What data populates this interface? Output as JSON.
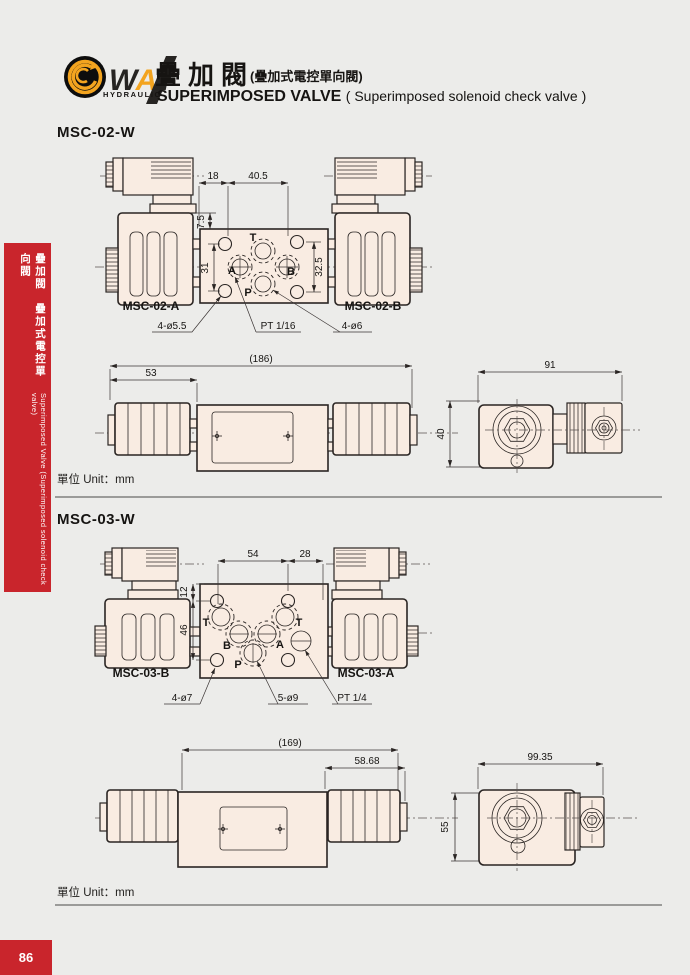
{
  "page": {
    "number": "86",
    "bg_color": "#ececea",
    "accent_red": "#c9252c",
    "drawing_fill": "#f9ece2",
    "logo_orange": "#f3a41f"
  },
  "header": {
    "logo": {
      "w": "W",
      "a": "A",
      "y": "Y",
      "hydraulic": "HYDRAULIC"
    },
    "title_zh": "疊加閥",
    "title_zh_paren": "(疊加式電控單向閥)",
    "title_en": "SUPERIMPOSED VALVE ",
    "title_en_paren": "( Superimposed solenoid check valve )"
  },
  "sidebar": {
    "zh": "疊加閥　疊加式電控單向閥",
    "en": "Superimposed Valve (Superimposed solenoid check valve)"
  },
  "msc02": {
    "title": "MSC-02-W",
    "unit": "單位 Unit：mm",
    "top": {
      "dim_a": "18",
      "dim_b": "40.5",
      "dim_c": "7.5",
      "dim_d": "31",
      "dim_e": "32.5",
      "port_t": "T",
      "port_a": "A",
      "port_b": "B",
      "port_p": "P",
      "label_left": "MSC-02-A",
      "label_right": "MSC-02-B",
      "callout_left": "4-ø5.5",
      "callout_mid": "PT 1/16",
      "callout_right": "4-ø6"
    },
    "side": {
      "dim_total": "(186)",
      "dim_left": "53"
    },
    "end": {
      "dim_width": "91",
      "dim_height": "40"
    }
  },
  "msc03": {
    "title": "MSC-03-W",
    "unit": "單位 Unit：mm",
    "top": {
      "dim_a": "54",
      "dim_b": "28",
      "dim_c": "12",
      "dim_d": "46",
      "port_t1": "T",
      "port_b": "B",
      "port_a": "A",
      "port_t2": "T",
      "port_p": "P",
      "label_left": "MSC-03-B",
      "label_right": "MSC-03-A",
      "callout_left": "4-ø7",
      "callout_mid": "5-ø9",
      "callout_right": "PT 1/4"
    },
    "side": {
      "dim_total": "(169)",
      "dim_right": "58.68"
    },
    "end": {
      "dim_width": "99.35",
      "dim_height": "55"
    }
  }
}
